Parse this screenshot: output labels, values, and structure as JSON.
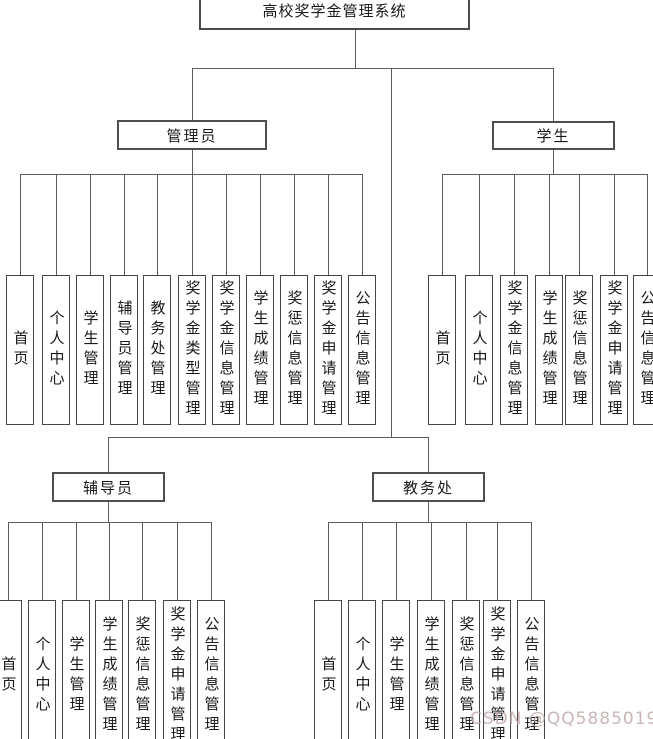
{
  "diagram_title": "高校奖学金管理系统",
  "watermark": "CSDN @QQ58850198",
  "colors": {
    "background": "#ffffff",
    "box_border": "#4a4a4a",
    "connector_line": "#5c5c5c",
    "text": "#1a1a1a",
    "watermark": "#c1aaaa"
  },
  "roles": {
    "admin": {
      "label": "管理员",
      "leaves": [
        "首页",
        "个人中心",
        "学生管理",
        "辅导员管理",
        "教务处管理",
        "奖学金类型管理",
        "奖学金信息管理",
        "学生成绩管理",
        "奖惩信息管理",
        "奖学金申请管理",
        "公告信息管理"
      ]
    },
    "student": {
      "label": "学生",
      "leaves": [
        "首页",
        "个人中心",
        "奖学金信息管理",
        "学生成绩管理",
        "奖惩信息管理",
        "奖学金申请管理",
        "公告信息管理"
      ]
    },
    "counselor": {
      "label": "辅导员",
      "leaves": [
        "首页",
        "个人中心",
        "学生管理",
        "学生成绩管理",
        "奖惩信息管理",
        "奖学金申请管理",
        "公告信息管理"
      ]
    },
    "academic": {
      "label": "教务处",
      "leaves": [
        "首页",
        "个人中心",
        "学生管理",
        "学生成绩管理",
        "奖惩信息管理",
        "奖学金申请管理",
        "公告信息管理"
      ]
    }
  }
}
